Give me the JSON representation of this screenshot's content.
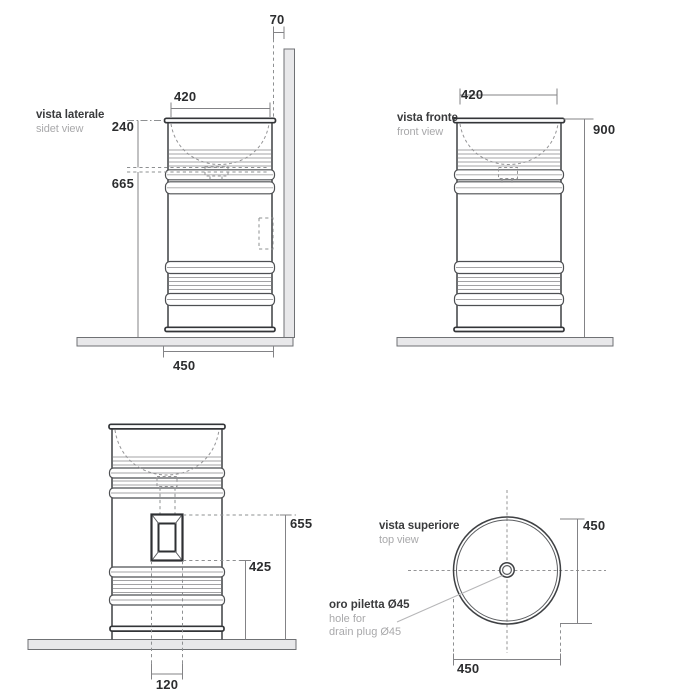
{
  "views": {
    "side": {
      "label_it": "vista laterale",
      "label_en": "sidet view",
      "dim_wall_gap": "70",
      "dim_top_width": "420",
      "dim_basin_depth": "240",
      "dim_under_basin": "665",
      "dim_base_width": "450"
    },
    "front": {
      "label_it": "vista fronte",
      "label_en": "front view",
      "dim_top_width": "420",
      "dim_height": "900"
    },
    "back": {
      "dim_hole_top": "655",
      "dim_hole_bottom": "425",
      "dim_hole_width": "120"
    },
    "top": {
      "label_it": "vista superiore",
      "label_en": "top view",
      "dim_diameter_right": "450",
      "dim_diameter_bottom": "450",
      "note_title": "oro piletta Ø45",
      "note_line2": "hole for",
      "note_line3": "drain plug Ø45"
    }
  },
  "colors": {
    "background": "#ffffff",
    "outline": "#3e4043",
    "thin_line": "#a3a3a5",
    "dimension_line": "#838386",
    "dimension_text": "#2c2d2f",
    "label_text": "#3a3b3d",
    "label_subtext": "#a9a9ab",
    "surface_fill": "#e8e8ea"
  }
}
